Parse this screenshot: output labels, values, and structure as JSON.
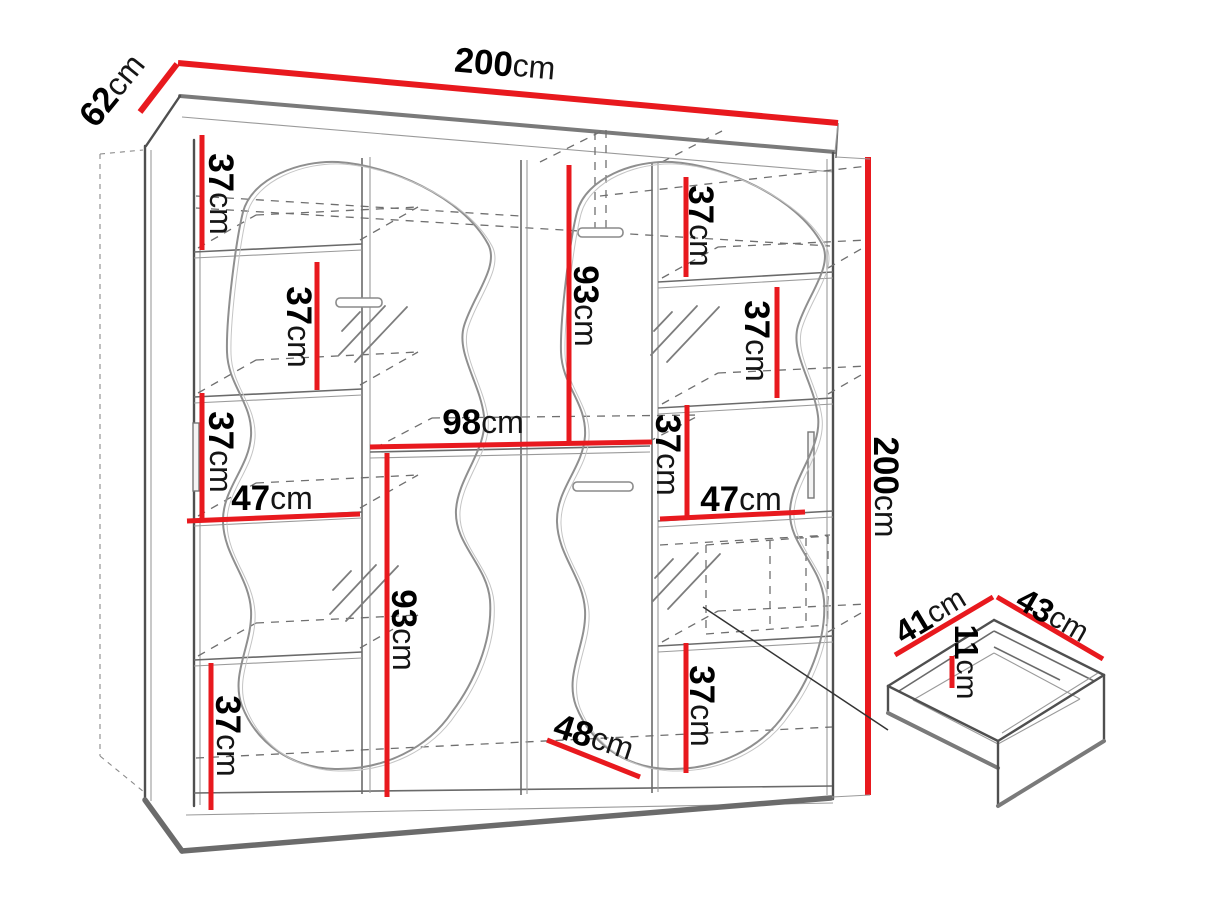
{
  "diagram": {
    "type": "furniture dimension drawing",
    "subject": "two-door sliding wardrobe with wavy mirror fronts and drawer detail",
    "colors": {
      "dimension_red": "#e8191e",
      "edge_gray": "#4f4f4f",
      "shadow_gray": "#6b6b6b",
      "hidden_line_gray": "#6f6f6f",
      "background": "#ffffff",
      "text_black": "#000000"
    },
    "dims": {
      "width_top": {
        "value": "200",
        "unit": "cm"
      },
      "depth_top": {
        "value": "62",
        "unit": "cm"
      },
      "height_right": {
        "value": "200",
        "unit": "cm"
      },
      "left_gap_top": {
        "value": "37",
        "unit": "cm"
      },
      "left_gap_mid": {
        "value": "37",
        "unit": "cm"
      },
      "left_gap_lower": {
        "value": "37",
        "unit": "cm"
      },
      "left_width": {
        "value": "47",
        "unit": "cm"
      },
      "left_gap_bottom": {
        "value": "37",
        "unit": "cm"
      },
      "center_height_top": {
        "value": "93",
        "unit": "cm"
      },
      "shelf_width": {
        "value": "98",
        "unit": "cm"
      },
      "left_hanging_height": {
        "value": "93",
        "unit": "cm"
      },
      "right_gap_top": {
        "value": "37",
        "unit": "cm"
      },
      "right_gap_upper": {
        "value": "37",
        "unit": "cm"
      },
      "right_gap_mid": {
        "value": "37",
        "unit": "cm"
      },
      "right_width": {
        "value": "47",
        "unit": "cm"
      },
      "right_gap_bottom": {
        "value": "37",
        "unit": "cm"
      },
      "door_diagonal": {
        "value": "48",
        "unit": "cm"
      },
      "drawer_depth": {
        "value": "41",
        "unit": "cm"
      },
      "drawer_width": {
        "value": "43",
        "unit": "cm"
      },
      "drawer_height": {
        "value": "11",
        "unit": "cm"
      }
    }
  }
}
